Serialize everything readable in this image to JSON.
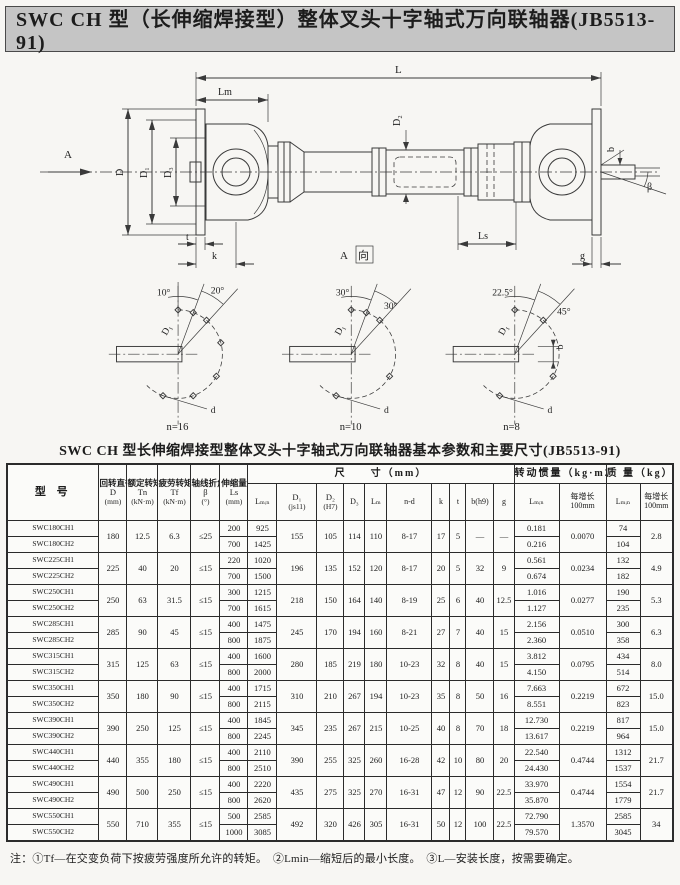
{
  "banner": {
    "title": "SWC CH 型（长伸缩焊接型）整体叉头十字轴式万向联轴器(JB5513-91)"
  },
  "drawing": {
    "labels": {
      "l": "L",
      "lm": "Lm",
      "a": "A",
      "d": "D",
      "d1": "D₁",
      "d3": "D₃",
      "d2": "D₂",
      "ls": "Ls",
      "t": "t",
      "k": "k",
      "g": "g",
      "b": "b",
      "beta": "β",
      "view_a": "A",
      "view_dir": "向"
    },
    "angle_diagrams": [
      {
        "a1": "10°",
        "a2": "20°",
        "dia": "D₁",
        "hole": "d",
        "n": "n=16"
      },
      {
        "a1": "30°",
        "a2": "30°",
        "dia": "D₁",
        "hole": "d",
        "n": "n=10"
      },
      {
        "a1": "22.5°",
        "a2": "45°",
        "dia": "D₁",
        "hole": "d",
        "b": "b",
        "n": "n=8"
      }
    ]
  },
  "table": {
    "title": "SWC CH 型长伸缩焊接型整体叉头十字轴式万向联轴器基本参数和主要尺寸(JB5513-91)",
    "headers": {
      "model": "型  号",
      "groups": {
        "size": "尺　　寸（mm）",
        "inertia": "转动惯量（kg·m2）",
        "mass": "质 量（kg）"
      },
      "d_name": "回转直径",
      "d_sym": "D",
      "d_unit": "(mm)",
      "tn_name": "额定转矩",
      "tn_sym": "Tn",
      "tn_unit": "(kN·m)",
      "tf_name": "疲劳转矩",
      "tf_sym": "Tf",
      "tf_unit": "(kN·m)",
      "beta_name": "轴线折角",
      "beta_sym": "β",
      "beta_unit": "(°)",
      "ls_name": "伸缩量",
      "ls_sym": "Ls",
      "ls_unit": "(mm)",
      "lmin": "Lₘᵢₙ",
      "d1_sym": "D₁",
      "d1_unit": "(js11)",
      "d2_sym": "D₂",
      "d2_unit": "(H7)",
      "d3": "D₃",
      "lm": "Lₘ",
      "nd": "n-d",
      "k": "k",
      "t": "t",
      "b": "b(h9)",
      "g": "g",
      "j_lmin": "Lₘᵢₙ",
      "j_inc1": "每增长",
      "j_inc2": "100mm",
      "m_lmin": "Lₘᵢₙ",
      "m_inc1": "每增长",
      "m_inc2": "100mm"
    },
    "rows": [
      {
        "model1": "SWC180CH1",
        "model2": "SWC180CH2",
        "d": "180",
        "tn": "12.5",
        "tf": "6.3",
        "beta": "≤25",
        "ls": [
          "200",
          "700"
        ],
        "lmin": [
          "925",
          "1425"
        ],
        "d1": "155",
        "d2": "105",
        "d3": "114",
        "lm": "110",
        "nd": "8-17",
        "k": "17",
        "t": "5",
        "b": "—",
        "g": "—",
        "j": [
          "0.181",
          "0.216"
        ],
        "jinc": "0.0070",
        "mass": [
          "74",
          "104"
        ],
        "minc": "2.8"
      },
      {
        "model1": "SWC225CH1",
        "model2": "SWC225CH2",
        "d": "225",
        "tn": "40",
        "tf": "20",
        "beta": "≤15",
        "ls": [
          "220",
          "700"
        ],
        "lmin": [
          "1020",
          "1500"
        ],
        "d1": "196",
        "d2": "135",
        "d3": "152",
        "lm": "120",
        "nd": "8-17",
        "k": "20",
        "t": "5",
        "b": "32",
        "g": "9",
        "j": [
          "0.561",
          "0.674"
        ],
        "jinc": "0.0234",
        "mass": [
          "132",
          "182"
        ],
        "minc": "4.9"
      },
      {
        "model1": "SWC250CH1",
        "model2": "SWC250CH2",
        "d": "250",
        "tn": "63",
        "tf": "31.5",
        "beta": "≤15",
        "ls": [
          "300",
          "700"
        ],
        "lmin": [
          "1215",
          "1615"
        ],
        "d1": "218",
        "d2": "150",
        "d3": "164",
        "lm": "140",
        "nd": "8-19",
        "k": "25",
        "t": "6",
        "b": "40",
        "g": "12.5",
        "j": [
          "1.016",
          "1.127"
        ],
        "jinc": "0.0277",
        "mass": [
          "190",
          "235"
        ],
        "minc": "5.3"
      },
      {
        "model1": "SWC285CH1",
        "model2": "SWC285CH2",
        "d": "285",
        "tn": "90",
        "tf": "45",
        "beta": "≤15",
        "ls": [
          "400",
          "800"
        ],
        "lmin": [
          "1475",
          "1875"
        ],
        "d1": "245",
        "d2": "170",
        "d3": "194",
        "lm": "160",
        "nd": "8-21",
        "k": "27",
        "t": "7",
        "b": "40",
        "g": "15",
        "j": [
          "2.156",
          "2.360"
        ],
        "jinc": "0.0510",
        "mass": [
          "300",
          "358"
        ],
        "minc": "6.3"
      },
      {
        "model1": "SWC315CH1",
        "model2": "SWC315CH2",
        "d": "315",
        "tn": "125",
        "tf": "63",
        "beta": "≤15",
        "ls": [
          "400",
          "800"
        ],
        "lmin": [
          "1600",
          "2000"
        ],
        "d1": "280",
        "d2": "185",
        "d3": "219",
        "lm": "180",
        "nd": "10-23",
        "k": "32",
        "t": "8",
        "b": "40",
        "g": "15",
        "j": [
          "3.812",
          "4.150"
        ],
        "jinc": "0.0795",
        "mass": [
          "434",
          "514"
        ],
        "minc": "8.0"
      },
      {
        "model1": "SWC350CH1",
        "model2": "SWC350CH2",
        "d": "350",
        "tn": "180",
        "tf": "90",
        "beta": "≤15",
        "ls": [
          "400",
          "800"
        ],
        "lmin": [
          "1715",
          "2115"
        ],
        "d1": "310",
        "d2": "210",
        "d3": "267",
        "lm": "194",
        "nd": "10-23",
        "k": "35",
        "t": "8",
        "b": "50",
        "g": "16",
        "j": [
          "7.663",
          "8.551"
        ],
        "jinc": "0.2219",
        "mass": [
          "672",
          "823"
        ],
        "minc": "15.0"
      },
      {
        "model1": "SWC390CH1",
        "model2": "SWC390CH2",
        "d": "390",
        "tn": "250",
        "tf": "125",
        "beta": "≤15",
        "ls": [
          "400",
          "800"
        ],
        "lmin": [
          "1845",
          "2245"
        ],
        "d1": "345",
        "d2": "235",
        "d3": "267",
        "lm": "215",
        "nd": "10-25",
        "k": "40",
        "t": "8",
        "b": "70",
        "g": "18",
        "j": [
          "12.730",
          "13.617"
        ],
        "jinc": "0.2219",
        "mass": [
          "817",
          "964"
        ],
        "minc": "15.0"
      },
      {
        "model1": "SWC440CH1",
        "model2": "SWC440CH2",
        "d": "440",
        "tn": "355",
        "tf": "180",
        "beta": "≤15",
        "ls": [
          "400",
          "800"
        ],
        "lmin": [
          "2110",
          "2510"
        ],
        "d1": "390",
        "d2": "255",
        "d3": "325",
        "lm": "260",
        "nd": "16-28",
        "k": "42",
        "t": "10",
        "b": "80",
        "g": "20",
        "j": [
          "22.540",
          "24.430"
        ],
        "jinc": "0.4744",
        "mass": [
          "1312",
          "1537"
        ],
        "minc": "21.7"
      },
      {
        "model1": "SWC490CH1",
        "model2": "SWC490CH2",
        "d": "490",
        "tn": "500",
        "tf": "250",
        "beta": "≤15",
        "ls": [
          "400",
          "800"
        ],
        "lmin": [
          "2220",
          "2620"
        ],
        "d1": "435",
        "d2": "275",
        "d3": "325",
        "lm": "270",
        "nd": "16-31",
        "k": "47",
        "t": "12",
        "b": "90",
        "g": "22.5",
        "j": [
          "33.970",
          "35.870"
        ],
        "jinc": "0.4744",
        "mass": [
          "1554",
          "1779"
        ],
        "minc": "21.7"
      },
      {
        "model1": "SWC550CH1",
        "model2": "SWC550CH2",
        "d": "550",
        "tn": "710",
        "tf": "355",
        "beta": "≤15",
        "ls": [
          "500",
          "1000"
        ],
        "lmin": [
          "2585",
          "3085"
        ],
        "d1": "492",
        "d2": "320",
        "d3": "426",
        "lm": "305",
        "nd": "16-31",
        "k": "50",
        "t": "12",
        "b": "100",
        "g": "22.5",
        "j": [
          "72.790",
          "79.570"
        ],
        "jinc": "1.3570",
        "mass": [
          "2585",
          "3045"
        ],
        "minc": "34"
      }
    ]
  },
  "footnote": "注：①Tf—在交变负荷下按疲劳强度所允许的转矩。　②Lmin—缩短后的最小长度。　③L—安装长度，按需要确定。"
}
